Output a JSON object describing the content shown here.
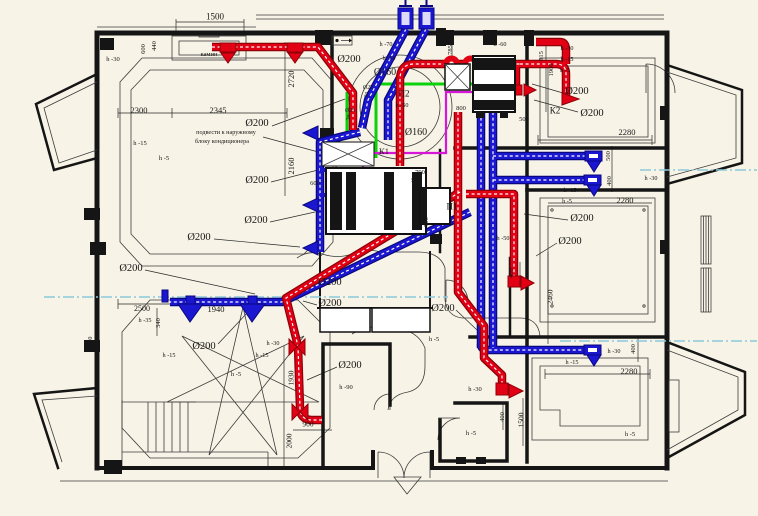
{
  "drawing": {
    "title": "HVAC ventilation floor plan",
    "language": "ru",
    "colors": {
      "bg": "#f7f3e6",
      "wall": "#151515",
      "supply": "#e10014",
      "supply_dark": "#8f0008",
      "exhaust": "#1b16cf",
      "exhaust_dark": "#090880",
      "condensate": "#0ad10a",
      "refrigerant": "#d816d8",
      "axis": "#8ccadc"
    },
    "equipment_tags": [
      "К1",
      "К2",
      "П1",
      "П2"
    ],
    "icon_legend": {
      "supply-diffuser-icon": "red triangle register",
      "exhaust-diffuser-icon": "blue triangle register",
      "valve-icon": "red bowtie damper",
      "shaft-anchor-icon": "roof shaft anchor",
      "entrance-arrow-icon": "entry triangle mark",
      "vent-marker-icon": "small wall vent marker"
    }
  },
  "annotations": [
    {
      "text": "1500",
      "x": 215,
      "y": 17,
      "size": 9,
      "kind": "dim"
    },
    {
      "text": "камин",
      "x": 209,
      "y": 55,
      "size": 6.5,
      "kind": "room"
    },
    {
      "text": "600",
      "x": 144,
      "y": 49,
      "size": 6.5,
      "kind": "dim",
      "rot": 1
    },
    {
      "text": "440",
      "x": 155,
      "y": 46,
      "size": 6.5,
      "kind": "dim",
      "rot": 1
    },
    {
      "text": "h -30",
      "x": 113,
      "y": 60,
      "size": 6.5,
      "kind": "height"
    },
    {
      "text": "2300",
      "x": 139,
      "y": 110,
      "size": 8.5,
      "kind": "dim"
    },
    {
      "text": "2345",
      "x": 218,
      "y": 110,
      "size": 8.5,
      "kind": "dim"
    },
    {
      "text": "2720",
      "x": 291,
      "y": 79,
      "size": 8.5,
      "kind": "dim",
      "rot": 1
    },
    {
      "text": "h -15",
      "x": 140,
      "y": 144,
      "size": 6.5,
      "kind": "height"
    },
    {
      "text": "h -5",
      "x": 164,
      "y": 159,
      "size": 6.5,
      "kind": "height"
    },
    {
      "text": "Ø200",
      "x": 257,
      "y": 124,
      "size": 10.5,
      "kind": "dia"
    },
    {
      "text": "подвести к наружному",
      "x": 226,
      "y": 133,
      "size": 6.2,
      "kind": "note"
    },
    {
      "text": "блоку кондиционера",
      "x": 222,
      "y": 142,
      "size": 6.2,
      "kind": "note"
    },
    {
      "text": "2160",
      "x": 291,
      "y": 166,
      "size": 8.5,
      "kind": "dim",
      "rot": 1
    },
    {
      "text": "Ø200",
      "x": 257,
      "y": 181,
      "size": 10.5,
      "kind": "dia"
    },
    {
      "text": "600",
      "x": 315,
      "y": 184,
      "size": 6.5,
      "kind": "dim"
    },
    {
      "text": "Ø200",
      "x": 256,
      "y": 221,
      "size": 10.5,
      "kind": "dia"
    },
    {
      "text": "Ø200",
      "x": 199,
      "y": 238,
      "size": 10.5,
      "kind": "dia"
    },
    {
      "text": "Ø200",
      "x": 131,
      "y": 269,
      "size": 10.5,
      "kind": "dia"
    },
    {
      "text": "h -70",
      "x": 386,
      "y": 45,
      "size": 6.2,
      "kind": "height"
    },
    {
      "text": "h -60",
      "x": 500,
      "y": 45,
      "size": 6.2,
      "kind": "height"
    },
    {
      "text": "Ø200",
      "x": 349,
      "y": 60,
      "size": 10.5,
      "kind": "dia"
    },
    {
      "text": "h -50",
      "x": 389,
      "y": 59,
      "size": 6.2,
      "kind": "height"
    },
    {
      "text": "Ø160",
      "x": 385,
      "y": 73,
      "size": 10,
      "kind": "dia"
    },
    {
      "text": "Ø25",
      "x": 368,
      "y": 89,
      "size": 5.8,
      "kind": "dia"
    },
    {
      "text": "Д",
      "x": 366,
      "y": 96,
      "size": 5.8,
      "kind": "dia"
    },
    {
      "text": "П2",
      "x": 404,
      "y": 94,
      "size": 9,
      "kind": "tag"
    },
    {
      "text": "h -50",
      "x": 402,
      "y": 106,
      "size": 6.2,
      "kind": "height"
    },
    {
      "text": "Ø25",
      "x": 350,
      "y": 112,
      "size": 5.8,
      "kind": "dia"
    },
    {
      "text": "Д",
      "x": 348,
      "y": 119,
      "size": 5.8,
      "kind": "dia"
    },
    {
      "text": "Ø160",
      "x": 416,
      "y": 133,
      "size": 10,
      "kind": "dia"
    },
    {
      "text": "К1",
      "x": 384,
      "y": 151,
      "size": 8.5,
      "kind": "tag"
    },
    {
      "text": "785",
      "x": 451,
      "y": 50,
      "size": 6.5,
      "kind": "dim",
      "rot": 1
    },
    {
      "text": "915",
      "x": 542,
      "y": 56,
      "size": 6.5,
      "kind": "dim",
      "rot": 1
    },
    {
      "text": "1900",
      "x": 552,
      "y": 70,
      "size": 6.5,
      "kind": "dim",
      "rot": 1
    },
    {
      "text": "h -30",
      "x": 567,
      "y": 49,
      "size": 6.2,
      "kind": "height"
    },
    {
      "text": "h -15",
      "x": 567,
      "y": 60,
      "size": 6.2,
      "kind": "height"
    },
    {
      "text": "h -5",
      "x": 565,
      "y": 71,
      "size": 6.2,
      "kind": "height"
    },
    {
      "text": "Ø200",
      "x": 577,
      "y": 92,
      "size": 10.5,
      "kind": "dia"
    },
    {
      "text": "К2",
      "x": 555,
      "y": 111,
      "size": 9,
      "kind": "tag"
    },
    {
      "text": "Ø200",
      "x": 592,
      "y": 114,
      "size": 10.5,
      "kind": "dia"
    },
    {
      "text": "2280",
      "x": 627,
      "y": 132,
      "size": 8.5,
      "kind": "dim"
    },
    {
      "text": "800",
      "x": 461,
      "y": 109,
      "size": 6.5,
      "kind": "dim"
    },
    {
      "text": "500",
      "x": 524,
      "y": 120,
      "size": 6.5,
      "kind": "dim"
    },
    {
      "text": "500",
      "x": 609,
      "y": 156,
      "size": 6.5,
      "kind": "dim",
      "rot": 1
    },
    {
      "text": "400",
      "x": 610,
      "y": 181,
      "size": 6.5,
      "kind": "dim",
      "rot": 1
    },
    {
      "text": "h -30",
      "x": 651,
      "y": 179,
      "size": 6.2,
      "kind": "height"
    },
    {
      "text": "790",
      "x": 420,
      "y": 173,
      "size": 6.5,
      "kind": "dim"
    },
    {
      "text": "575",
      "x": 416,
      "y": 181,
      "size": 6.5,
      "kind": "dim"
    },
    {
      "text": "П1",
      "x": 452,
      "y": 207,
      "size": 9,
      "kind": "tag"
    },
    {
      "text": "700",
      "x": 427,
      "y": 222,
      "size": 6.5,
      "kind": "dim",
      "rot": 1
    },
    {
      "text": "h -15",
      "x": 570,
      "y": 191,
      "size": 6.2,
      "kind": "height"
    },
    {
      "text": "h -5",
      "x": 567,
      "y": 202,
      "size": 6.2,
      "kind": "height"
    },
    {
      "text": "2280",
      "x": 625,
      "y": 200,
      "size": 8.5,
      "kind": "dim"
    },
    {
      "text": "Ø200",
      "x": 582,
      "y": 219,
      "size": 10.5,
      "kind": "dia"
    },
    {
      "text": "Ø200",
      "x": 570,
      "y": 242,
      "size": 10.5,
      "kind": "dia"
    },
    {
      "text": "h -50",
      "x": 503,
      "y": 239,
      "size": 6.2,
      "kind": "height"
    },
    {
      "text": "400",
      "x": 512,
      "y": 273,
      "size": 6.5,
      "kind": "dim",
      "rot": 1
    },
    {
      "text": "2460",
      "x": 550,
      "y": 297,
      "size": 7.5,
      "kind": "dim",
      "rot": 1
    },
    {
      "text": "Ø200",
      "x": 330,
      "y": 283,
      "size": 10.5,
      "kind": "dia"
    },
    {
      "text": "Ø200",
      "x": 330,
      "y": 304,
      "size": 10.5,
      "kind": "dia"
    },
    {
      "text": "Ø200",
      "x": 443,
      "y": 309,
      "size": 10.5,
      "kind": "dia"
    },
    {
      "text": "h -5",
      "x": 434,
      "y": 340,
      "size": 6.5,
      "kind": "height"
    },
    {
      "text": "2500",
      "x": 142,
      "y": 309,
      "size": 8,
      "kind": "dim"
    },
    {
      "text": "1940",
      "x": 216,
      "y": 309,
      "size": 8.5,
      "kind": "dim"
    },
    {
      "text": "h -35",
      "x": 145,
      "y": 321,
      "size": 6.2,
      "kind": "height"
    },
    {
      "text": "340",
      "x": 159,
      "y": 323,
      "size": 6.5,
      "kind": "dim",
      "rot": 1
    },
    {
      "text": "h -30",
      "x": 91,
      "y": 343,
      "size": 6.2,
      "kind": "height",
      "rot": 1
    },
    {
      "text": "Ø200",
      "x": 204,
      "y": 347,
      "size": 10.5,
      "kind": "dia"
    },
    {
      "text": "h -15",
      "x": 169,
      "y": 356,
      "size": 6.2,
      "kind": "height"
    },
    {
      "text": "h -15",
      "x": 262,
      "y": 356,
      "size": 6.2,
      "kind": "height"
    },
    {
      "text": "h -5",
      "x": 236,
      "y": 375,
      "size": 6.5,
      "kind": "height"
    },
    {
      "text": "h -30",
      "x": 273,
      "y": 344,
      "size": 6.2,
      "kind": "height"
    },
    {
      "text": "1930",
      "x": 291,
      "y": 378,
      "size": 7.5,
      "kind": "dim",
      "rot": 1
    },
    {
      "text": "Ø200",
      "x": 350,
      "y": 366,
      "size": 10.5,
      "kind": "dia"
    },
    {
      "text": "h -90",
      "x": 346,
      "y": 388,
      "size": 6.5,
      "kind": "height"
    },
    {
      "text": "900",
      "x": 308,
      "y": 424,
      "size": 7.5,
      "kind": "dim"
    },
    {
      "text": "2000",
      "x": 289,
      "y": 441,
      "size": 7.5,
      "kind": "dim",
      "rot": 1
    },
    {
      "text": "h -30",
      "x": 475,
      "y": 390,
      "size": 6.5,
      "kind": "height"
    },
    {
      "text": "h -5",
      "x": 471,
      "y": 434,
      "size": 6.5,
      "kind": "height"
    },
    {
      "text": "400",
      "x": 503,
      "y": 417,
      "size": 6.5,
      "kind": "dim",
      "rot": 1
    },
    {
      "text": "1500",
      "x": 521,
      "y": 420,
      "size": 7.5,
      "kind": "dim",
      "rot": 1
    },
    {
      "text": "h -30",
      "x": 614,
      "y": 352,
      "size": 6.2,
      "kind": "height"
    },
    {
      "text": "400",
      "x": 634,
      "y": 349,
      "size": 6.5,
      "kind": "dim",
      "rot": 1
    },
    {
      "text": "h -15",
      "x": 572,
      "y": 363,
      "size": 6.2,
      "kind": "height"
    },
    {
      "text": "2280",
      "x": 629,
      "y": 371,
      "size": 8.5,
      "kind": "dim"
    },
    {
      "text": "h -5",
      "x": 630,
      "y": 435,
      "size": 6.5,
      "kind": "height"
    }
  ]
}
